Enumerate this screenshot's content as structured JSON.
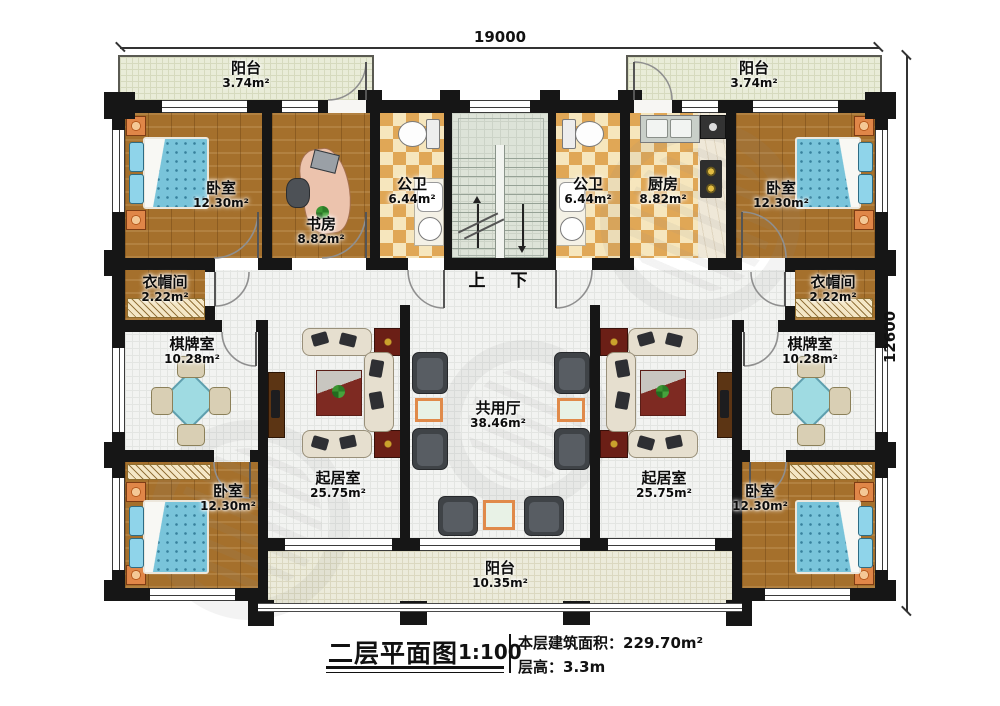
{
  "title": {
    "main": "二层平面图",
    "scale": "1:100",
    "area_label": "本层建筑面积：",
    "area_value": "229.70m²",
    "height_label": "层高：",
    "height_value": "3.3m"
  },
  "dims": {
    "top": "19000",
    "right": "12600"
  },
  "stairs": {
    "up": "上",
    "down": "下"
  },
  "rooms": {
    "balcony_tl": {
      "name": "阳台",
      "area": "3.74m²"
    },
    "balcony_tr": {
      "name": "阳台",
      "area": "3.74m²"
    },
    "bedroom_tl": {
      "name": "卧室",
      "area": "12.30m²"
    },
    "bedroom_tr": {
      "name": "卧室",
      "area": "12.30m²"
    },
    "study": {
      "name": "书房",
      "area": "8.82m²"
    },
    "kitchen": {
      "name": "厨房",
      "area": "8.82m²"
    },
    "bath_l": {
      "name": "公卫",
      "area": "6.44m²"
    },
    "bath_r": {
      "name": "公卫",
      "area": "6.44m²"
    },
    "cloak_l": {
      "name": "衣帽间",
      "area": "2.22m²"
    },
    "cloak_r": {
      "name": "衣帽间",
      "area": "2.22m²"
    },
    "games_l": {
      "name": "棋牌室",
      "area": "10.28m²"
    },
    "games_r": {
      "name": "棋牌室",
      "area": "10.28m²"
    },
    "living_l": {
      "name": "起居室",
      "area": "25.75m²"
    },
    "living_r": {
      "name": "起居室",
      "area": "25.75m²"
    },
    "hall": {
      "name": "共用厅",
      "area": "38.46m²"
    },
    "bedroom_bl": {
      "name": "卧室",
      "area": "12.30m²"
    },
    "bedroom_br": {
      "name": "卧室",
      "area": "12.30m²"
    },
    "balcony_b": {
      "name": "阳台",
      "area": "10.35m²"
    }
  }
}
